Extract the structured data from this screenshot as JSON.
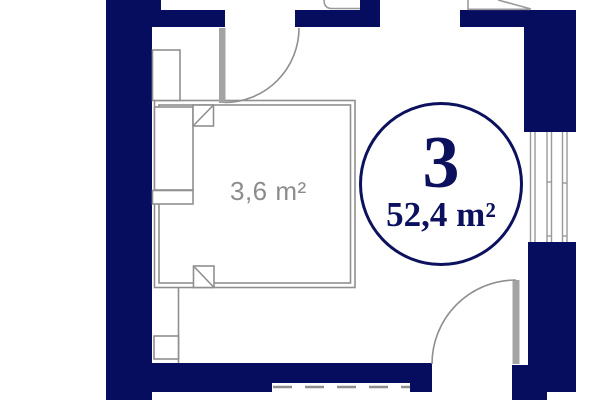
{
  "badge": {
    "unit_number": "3",
    "total_area": "52,4 m²"
  },
  "labels": {
    "closet_area": "3,6 m²"
  },
  "colors": {
    "wall": "#060c5e",
    "badge_outline": "#0c115e",
    "badge_text": "#0c115e",
    "partition_line": "#8f8f8f",
    "window_line": "#9a9a9a",
    "door_leaf": "#a3a3a3",
    "area_label": "#8c8c8c",
    "background": "#ffffff"
  }
}
